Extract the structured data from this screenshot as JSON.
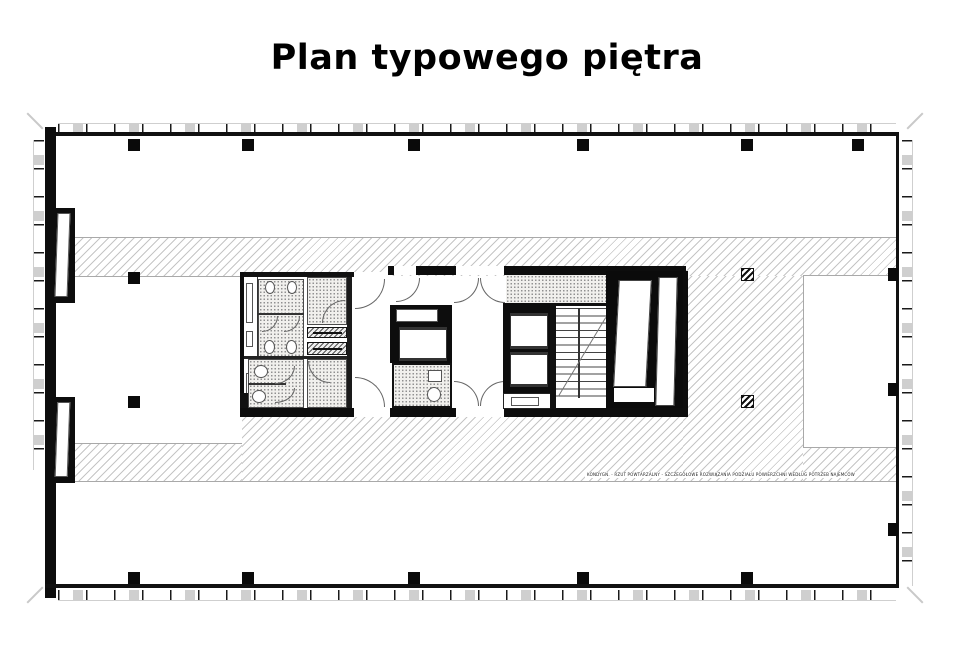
{
  "title": "Plan typowego piętra",
  "plan": {
    "annotation": "KONDYGN. - RZUT POWTARZALNY - SZCZEGÓŁOWE ROZWIĄZANIA PODZIAŁU POWIERZCHNI WEDŁUG POTRZEB NAJEMCÓW",
    "colors": {
      "ink": "#111111",
      "wall": "#0d0d0d",
      "hatch_line": "#969696",
      "stipple_bg": "#f1f0ed",
      "stipple_dot": "#8f8f8f",
      "mullion_gray": "#cfcfcf"
    }
  }
}
